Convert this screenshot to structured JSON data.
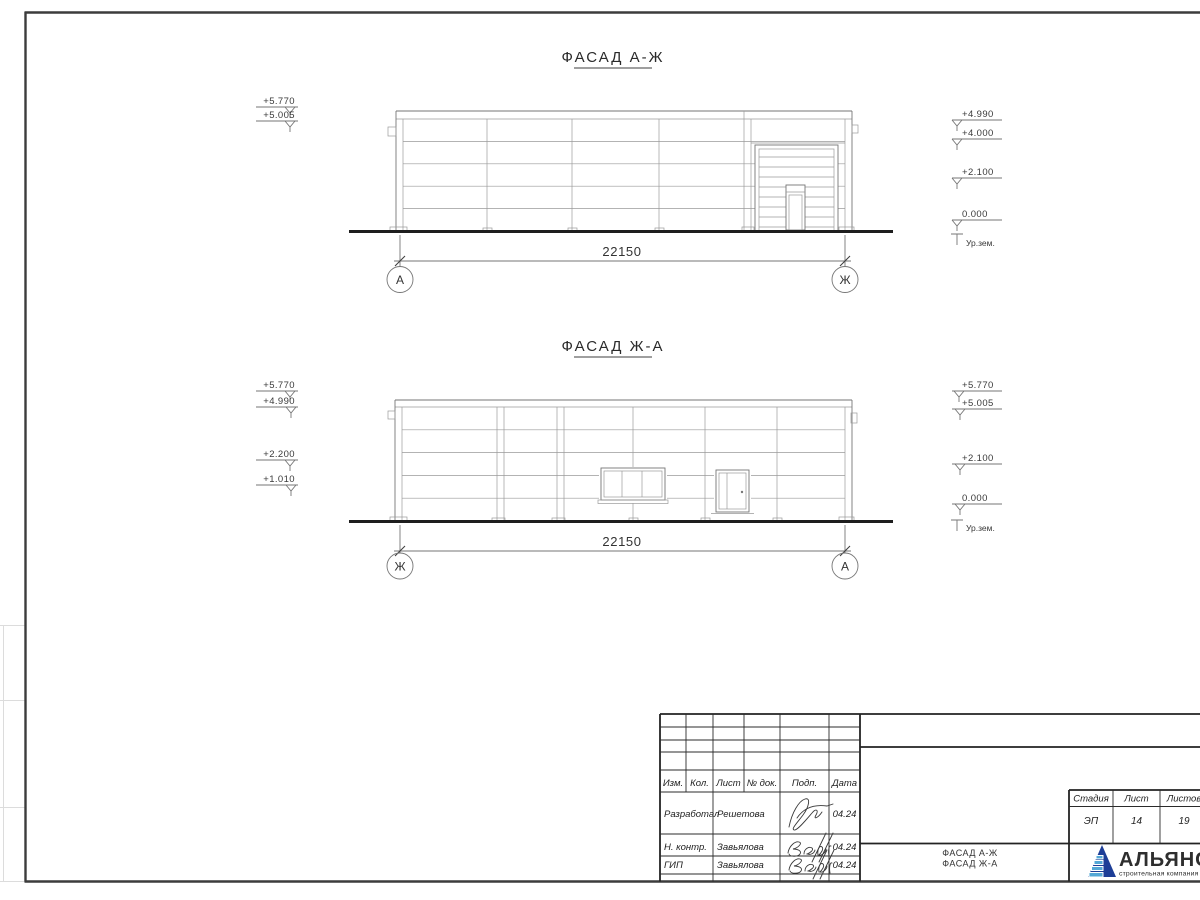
{
  "facade1": {
    "title": "ФАСАД А-Ж",
    "dim": "22150",
    "axis_left": "А",
    "axis_right": "Ж",
    "levels_left": [
      "+5.770",
      "+5.005"
    ],
    "levels_right": [
      "+4.990",
      "+4.000",
      "+2.100",
      "0.000"
    ],
    "ground_label": "Ур.зем."
  },
  "facade2": {
    "title": "ФАСАД Ж-А",
    "dim": "22150",
    "axis_left": "Ж",
    "axis_right": "А",
    "levels_left": [
      "+5.770",
      "+4.990",
      "+2.200",
      "+1.010"
    ],
    "levels_right": [
      "+5.770",
      "+5.005",
      "+2.100",
      "0.000"
    ],
    "ground_label": "Ур.зем."
  },
  "titleblock": {
    "rev_header": [
      "Изм.",
      "Кол.",
      "Лист",
      "№ док.",
      "Подп.",
      "Дата"
    ],
    "sign_rows": [
      {
        "role": "Разработал",
        "name": "Решетова",
        "date": "04.24"
      },
      {
        "role": "Н. контр.",
        "name": "Завьялова",
        "date": "04.24"
      },
      {
        "role": "ГИП",
        "name": "Завьялова",
        "date": "04.24"
      }
    ],
    "stage_header": [
      "Стадия",
      "Лист",
      "Листов"
    ],
    "stage_values": [
      "ЭП",
      "14",
      "19"
    ],
    "doc_title_line1": "ФАСАД А-Ж",
    "doc_title_line2": "ФАСАД Ж-А",
    "logo": {
      "name": "АЛЬЯНС",
      "subtitle": "строительная компания"
    }
  },
  "colors": {
    "logo_blue": "#1d3e97",
    "logo_light_blue": "#55a8d6",
    "logo_red": "#c03a2b"
  }
}
